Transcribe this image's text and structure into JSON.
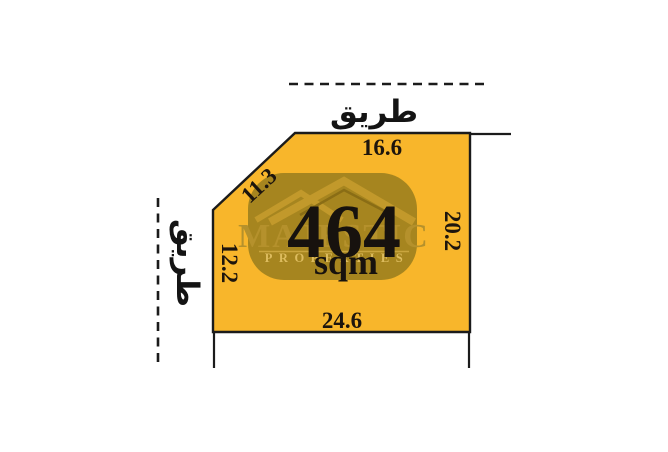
{
  "diagram": {
    "title_hint": "land-plot-site-plan",
    "plot": {
      "area_value": "464",
      "area_unit": "sqm",
      "dimensions": {
        "top": "16.6",
        "diagonal": "11.3",
        "left": "12.2",
        "right": "20.2",
        "bottom": "24.6"
      }
    },
    "roads": {
      "top_label": "طريق",
      "left_label": "طريق"
    },
    "watermark": {
      "brand": "MAJESTIC",
      "brand_sub": "PROPERTIES",
      "bg_color": "#A6851F",
      "logo_color": "#C2992B",
      "logo_shadow_color": "#8A6D15",
      "brand_text_color": "#B5912C",
      "sub_text_color": "#DDBC5E"
    },
    "colors": {
      "plot_fill": "#F8B62B",
      "outline": "#1B1B1B",
      "background": "#FFFFFF",
      "label_text": "#1D150D"
    }
  }
}
